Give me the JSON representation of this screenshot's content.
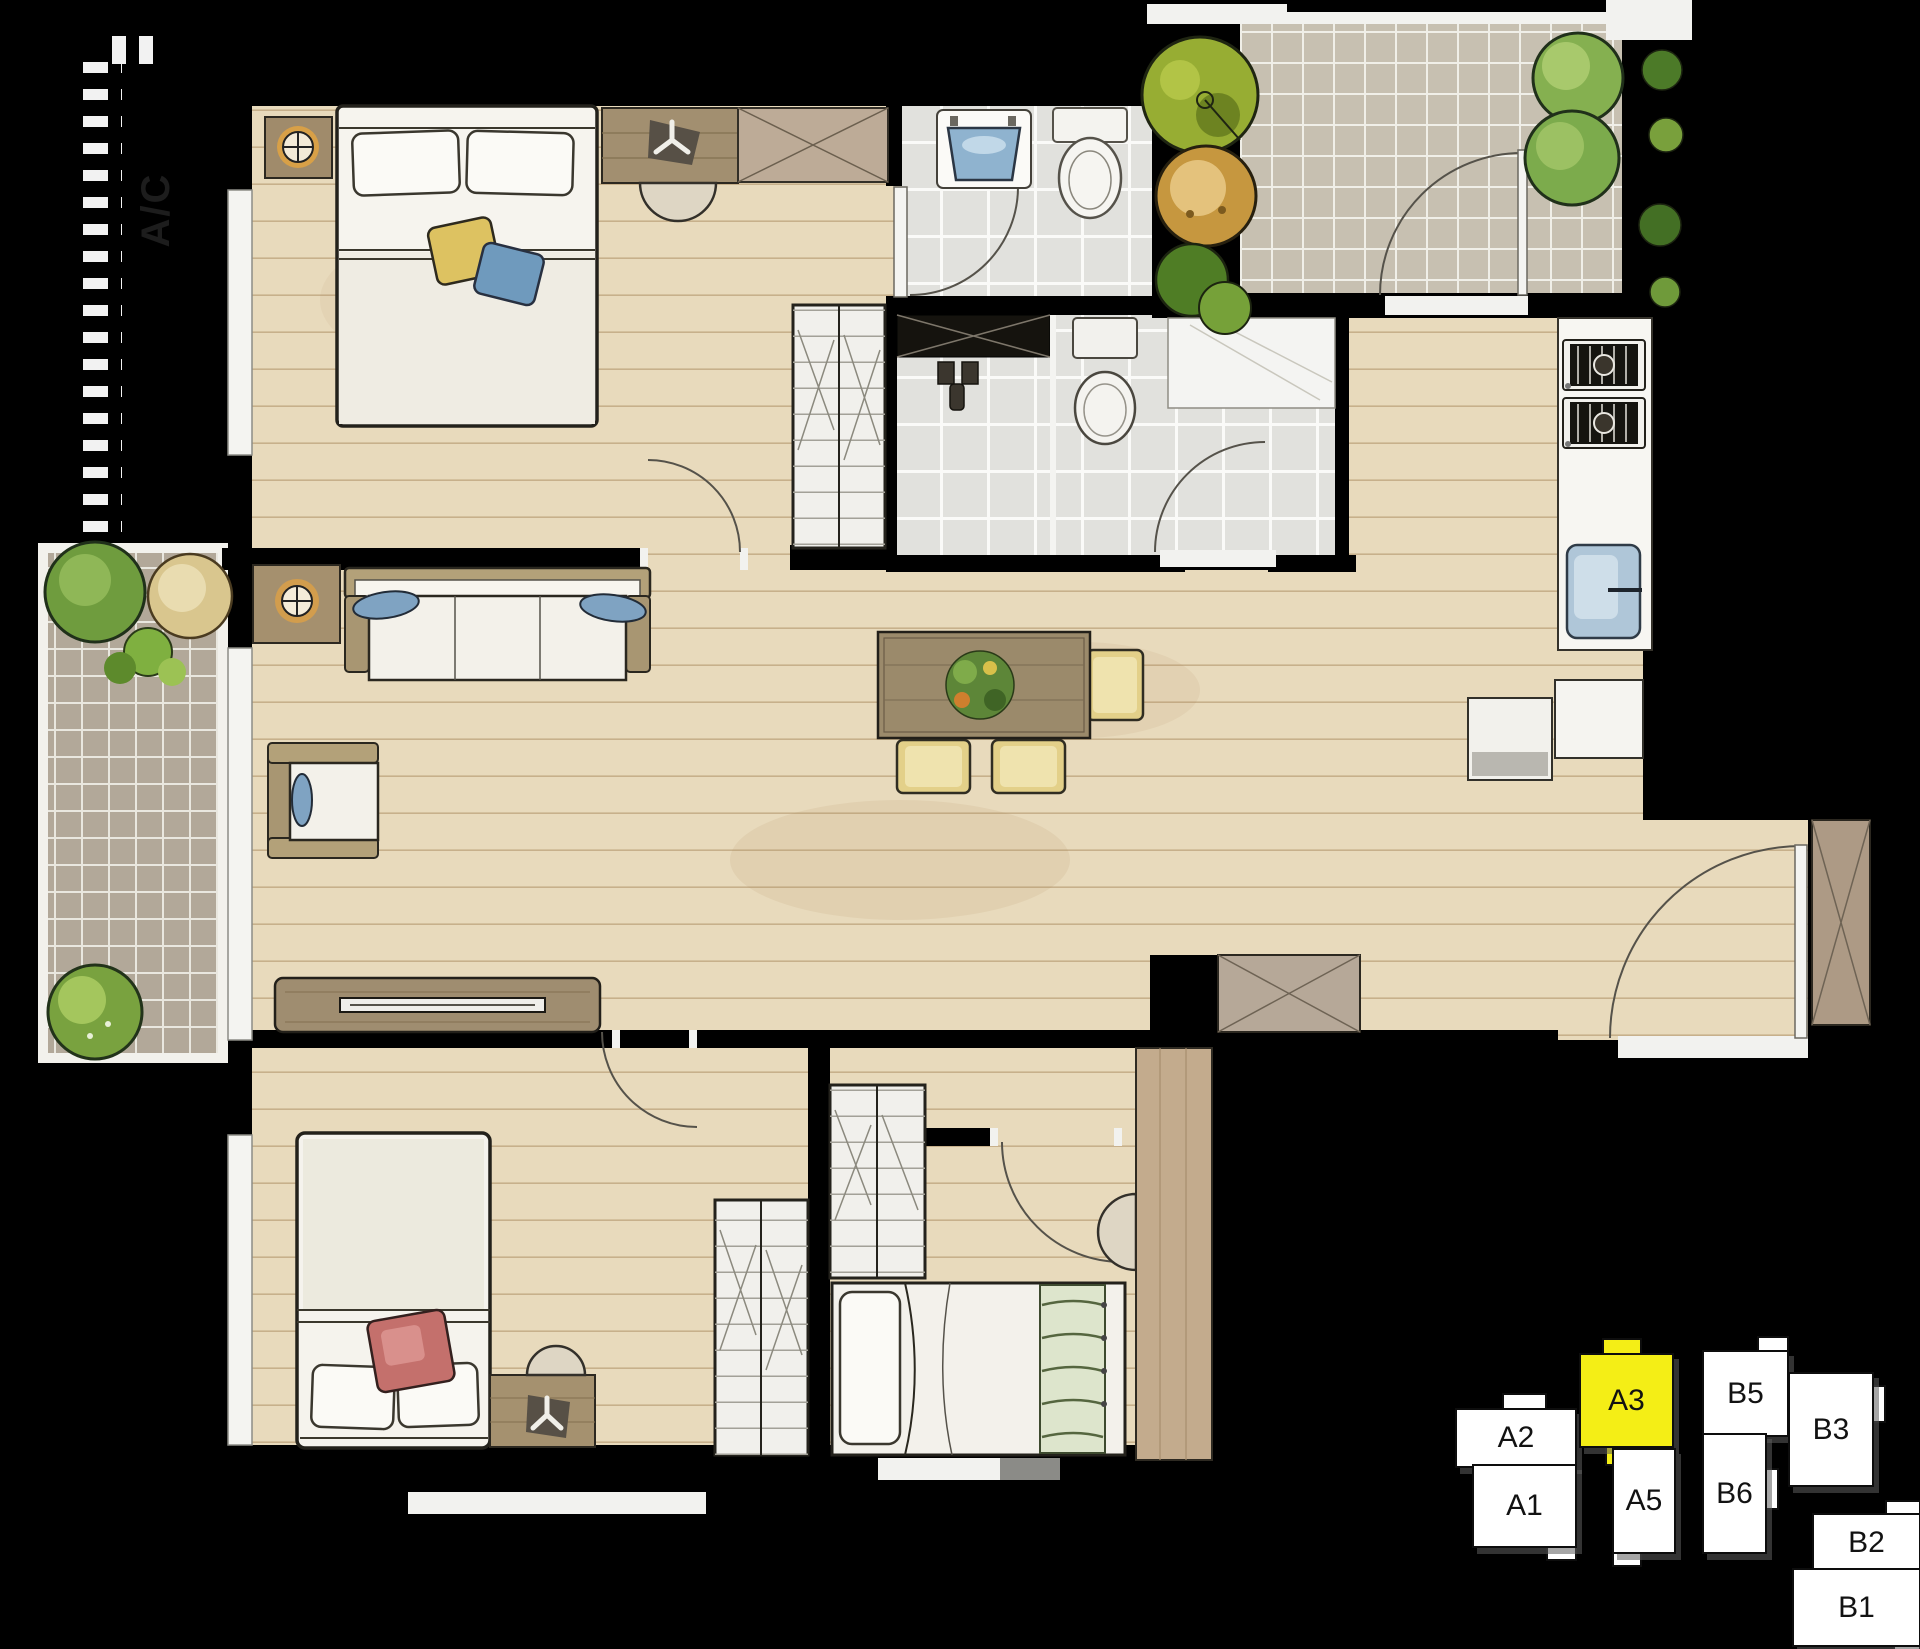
{
  "floor_plan": {
    "ac_label": "A/C",
    "colors": {
      "background": "#000000",
      "wood_floor": "#e8dabc",
      "bath_tile": "#e1e1dd",
      "terrace_tile": "#c7c0b1",
      "balcony_tile": "#b2a899",
      "highlight": "#f4ee16"
    }
  },
  "key_plan": {
    "highlighted_unit": "A3",
    "units": [
      {
        "label": "A2",
        "highlighted": false
      },
      {
        "label": "A1",
        "highlighted": false
      },
      {
        "label": "A3",
        "highlighted": true
      },
      {
        "label": "A5",
        "highlighted": false
      },
      {
        "label": "B5",
        "highlighted": false
      },
      {
        "label": "B6",
        "highlighted": false
      },
      {
        "label": "B3",
        "highlighted": false
      },
      {
        "label": "B2",
        "highlighted": false
      },
      {
        "label": "B1",
        "highlighted": false
      }
    ]
  }
}
